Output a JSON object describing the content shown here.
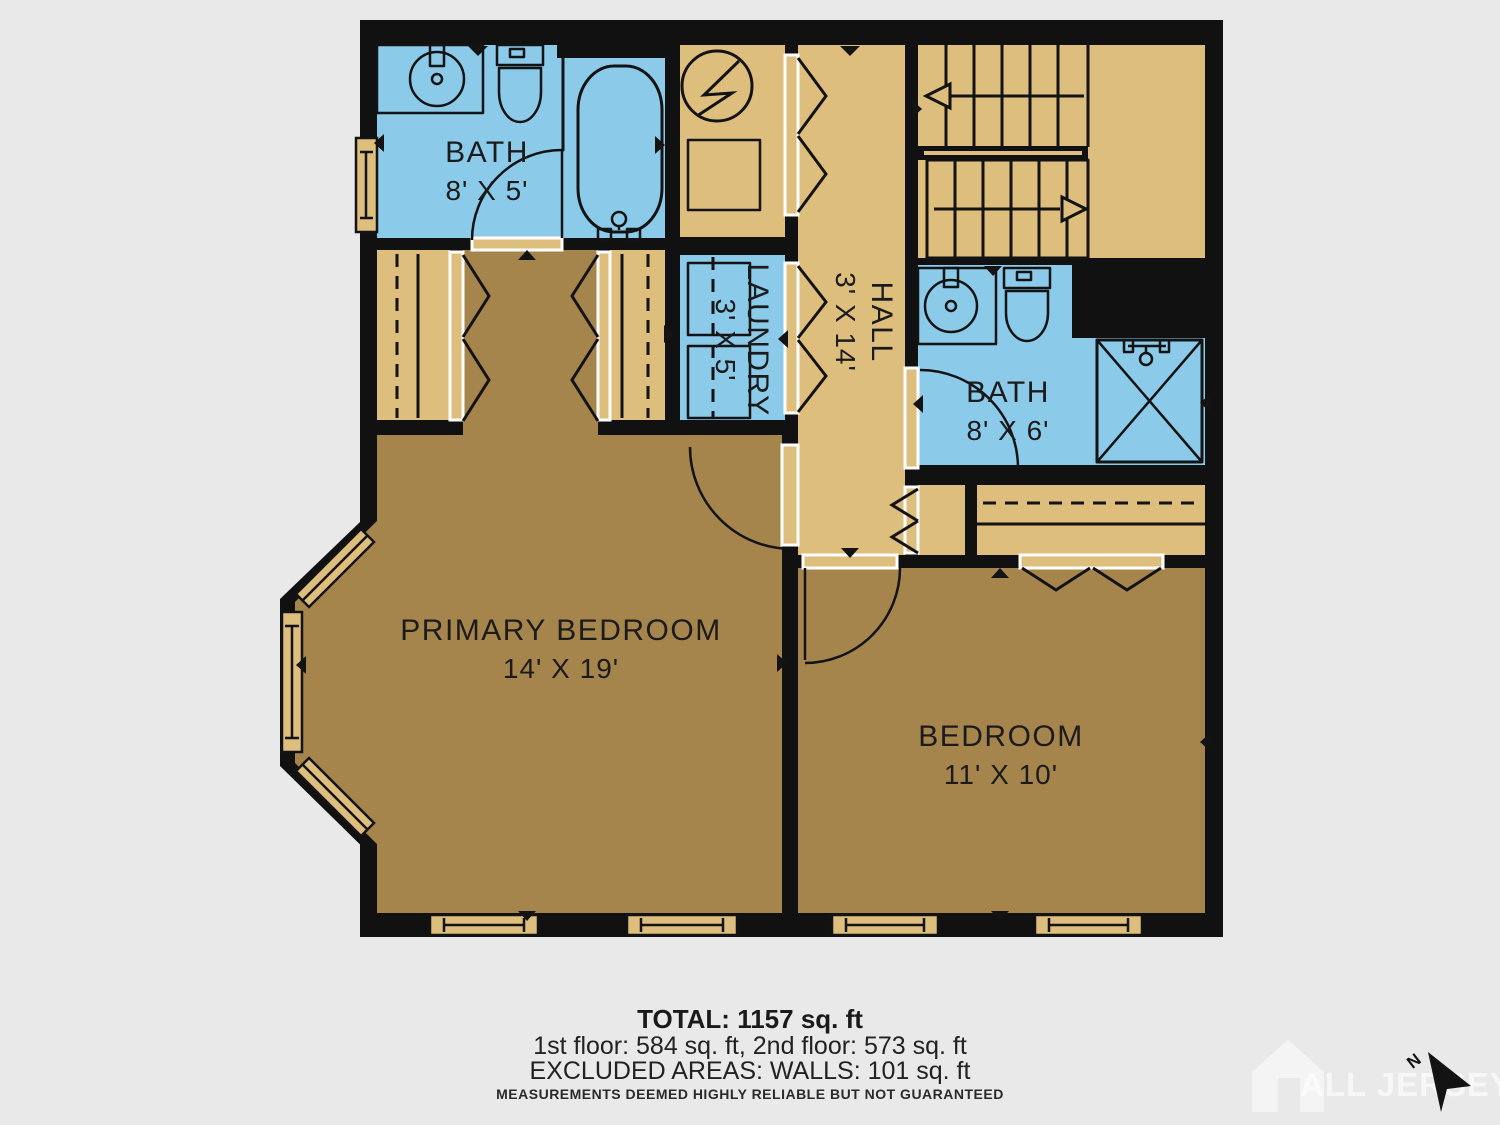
{
  "plan": {
    "rooms": {
      "bath_top": {
        "name": "BATH",
        "dims": "8' X 5'"
      },
      "laundry": {
        "name": "LAUNDRY",
        "dims": "3' X 5'"
      },
      "hall": {
        "name": "HALL",
        "dims": "3' X 14'"
      },
      "bath_right": {
        "name": "BATH",
        "dims": "8' X 6'"
      },
      "primary": {
        "name": "PRIMARY BEDROOM",
        "dims": "14' X 19'"
      },
      "bedroom": {
        "name": "BEDROOM",
        "dims": "11' X 10'"
      }
    },
    "colors": {
      "wet_room_floor": "#8BCBE9",
      "hall_floor": "#DDBE7D",
      "bedroom_floor": "#A6854D",
      "wall": "#111111",
      "background": "#e9e9e9"
    }
  },
  "footer": {
    "total": "TOTAL: 1157 sq. ft",
    "floors": "1st floor: 584 sq. ft, 2nd floor: 573 sq. ft",
    "excluded": "EXCLUDED AREAS: WALLS: 101 sq. ft",
    "disclaimer": "MEASUREMENTS DEEMED HIGHLY RELIABLE BUT NOT GUARANTEED"
  },
  "watermark": {
    "text": "ALL JERSEY MLS"
  },
  "compass": {
    "label": "N"
  }
}
